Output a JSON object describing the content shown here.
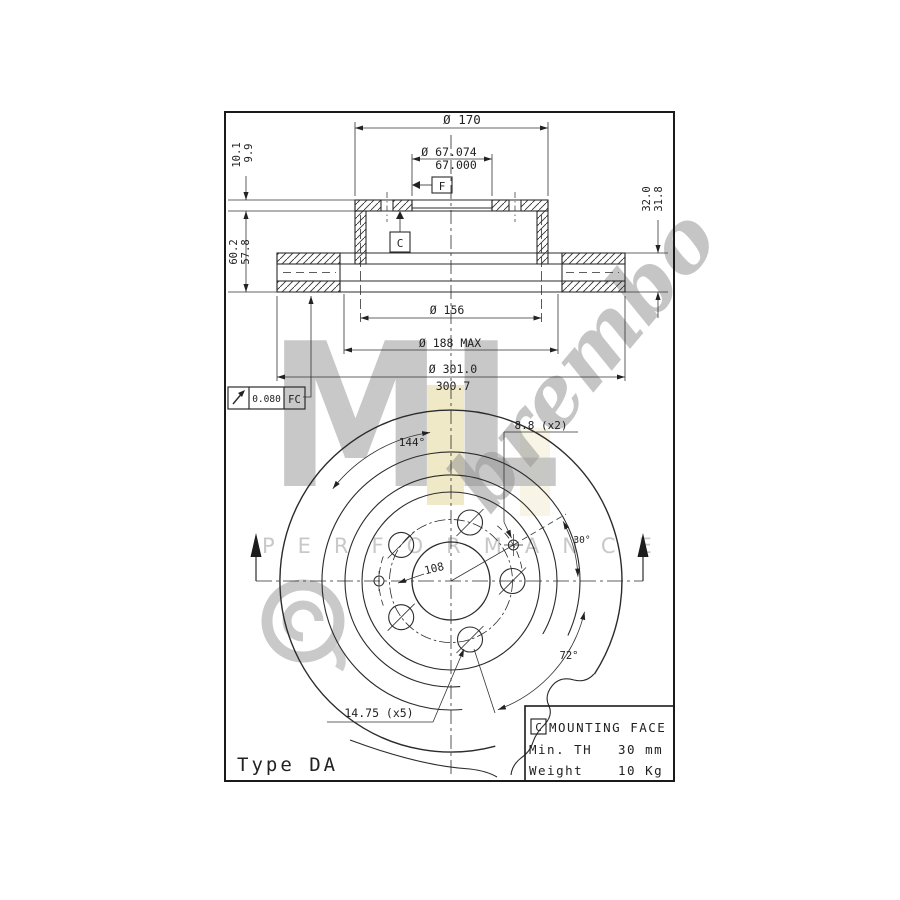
{
  "section_view": {
    "dia_hat": "Ø 170",
    "bore_upper": "Ø 67.074",
    "bore_lower": "67.000",
    "datum_f": "F",
    "datum_c": "C",
    "dim_flange_upper": "10.1",
    "dim_flange_lower": "9.9",
    "dim_height_upper": "60.2",
    "dim_height_lower": "57.8",
    "dim_thickness_upper": "32.0",
    "dim_thickness_lower": "31.8",
    "dia_mount": "Ø 156",
    "dia_inner_max": "Ø 188 MAX",
    "dia_outer_upper": "Ø 301.0",
    "dia_outer_lower": "300.7",
    "fcf_value": "0.080",
    "fcf_datum": "FC"
  },
  "front_view": {
    "angle_144": "144°",
    "small_holes": "8.8 (x2)",
    "angle_30": "30°",
    "bolt_circle": "108",
    "angle_72": "72°",
    "main_holes": "14.75 (x5)"
  },
  "info_box": {
    "datum": "C",
    "title": "MOUNTING FACE",
    "row1_label": "Min. TH",
    "row1_value": "30 mm",
    "row2_label": "Weight",
    "row2_value": "10 Kg"
  },
  "footer": {
    "type_label": "Type DA"
  },
  "watermark": {
    "letters": "ML",
    "script": "brembo",
    "performance": "PERFORMANCE"
  },
  "colors": {
    "line": "#2b2b2b",
    "thin_line": "#3a3a3a",
    "watermark_gray": "#bfbfbf",
    "stripe_beige": "#ece3ba",
    "background": "#ffffff"
  }
}
